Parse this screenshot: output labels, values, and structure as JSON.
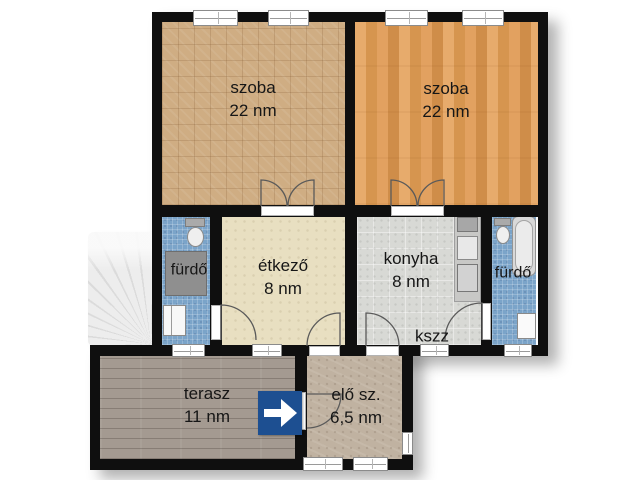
{
  "plan_title": "floor-plan",
  "rooms": {
    "szoba_left": {
      "label": "szoba",
      "area": "22 nm"
    },
    "szoba_right": {
      "label": "szoba",
      "area": "22 nm"
    },
    "etkezo": {
      "label": "étkező",
      "area": "8 nm"
    },
    "konyha": {
      "label": "konyha",
      "area": "8 nm"
    },
    "furdo_left": {
      "label": "fürdő"
    },
    "furdo_right": {
      "label": "fürdő"
    },
    "kszz": {
      "label": "kszz"
    },
    "terasz": {
      "label": "terasz",
      "area": "11 nm"
    },
    "elo_szoba": {
      "label": "elő sz.",
      "area": "6,5 nm"
    }
  },
  "entrance": {
    "icon": "arrow-right",
    "color": "#1d4f91"
  },
  "colors": {
    "wall": "#0f0f0f",
    "szoba_left_floor": "#cfad83",
    "szoba_right_floor": "#e1a261",
    "etkezo_floor": "#e8dfc1",
    "konyha_floor": "#d8d9d5",
    "furdo_floor": "#7ba4c9",
    "terasz_floor": "#a49a91",
    "elo_floor": "#c0b2a1"
  }
}
